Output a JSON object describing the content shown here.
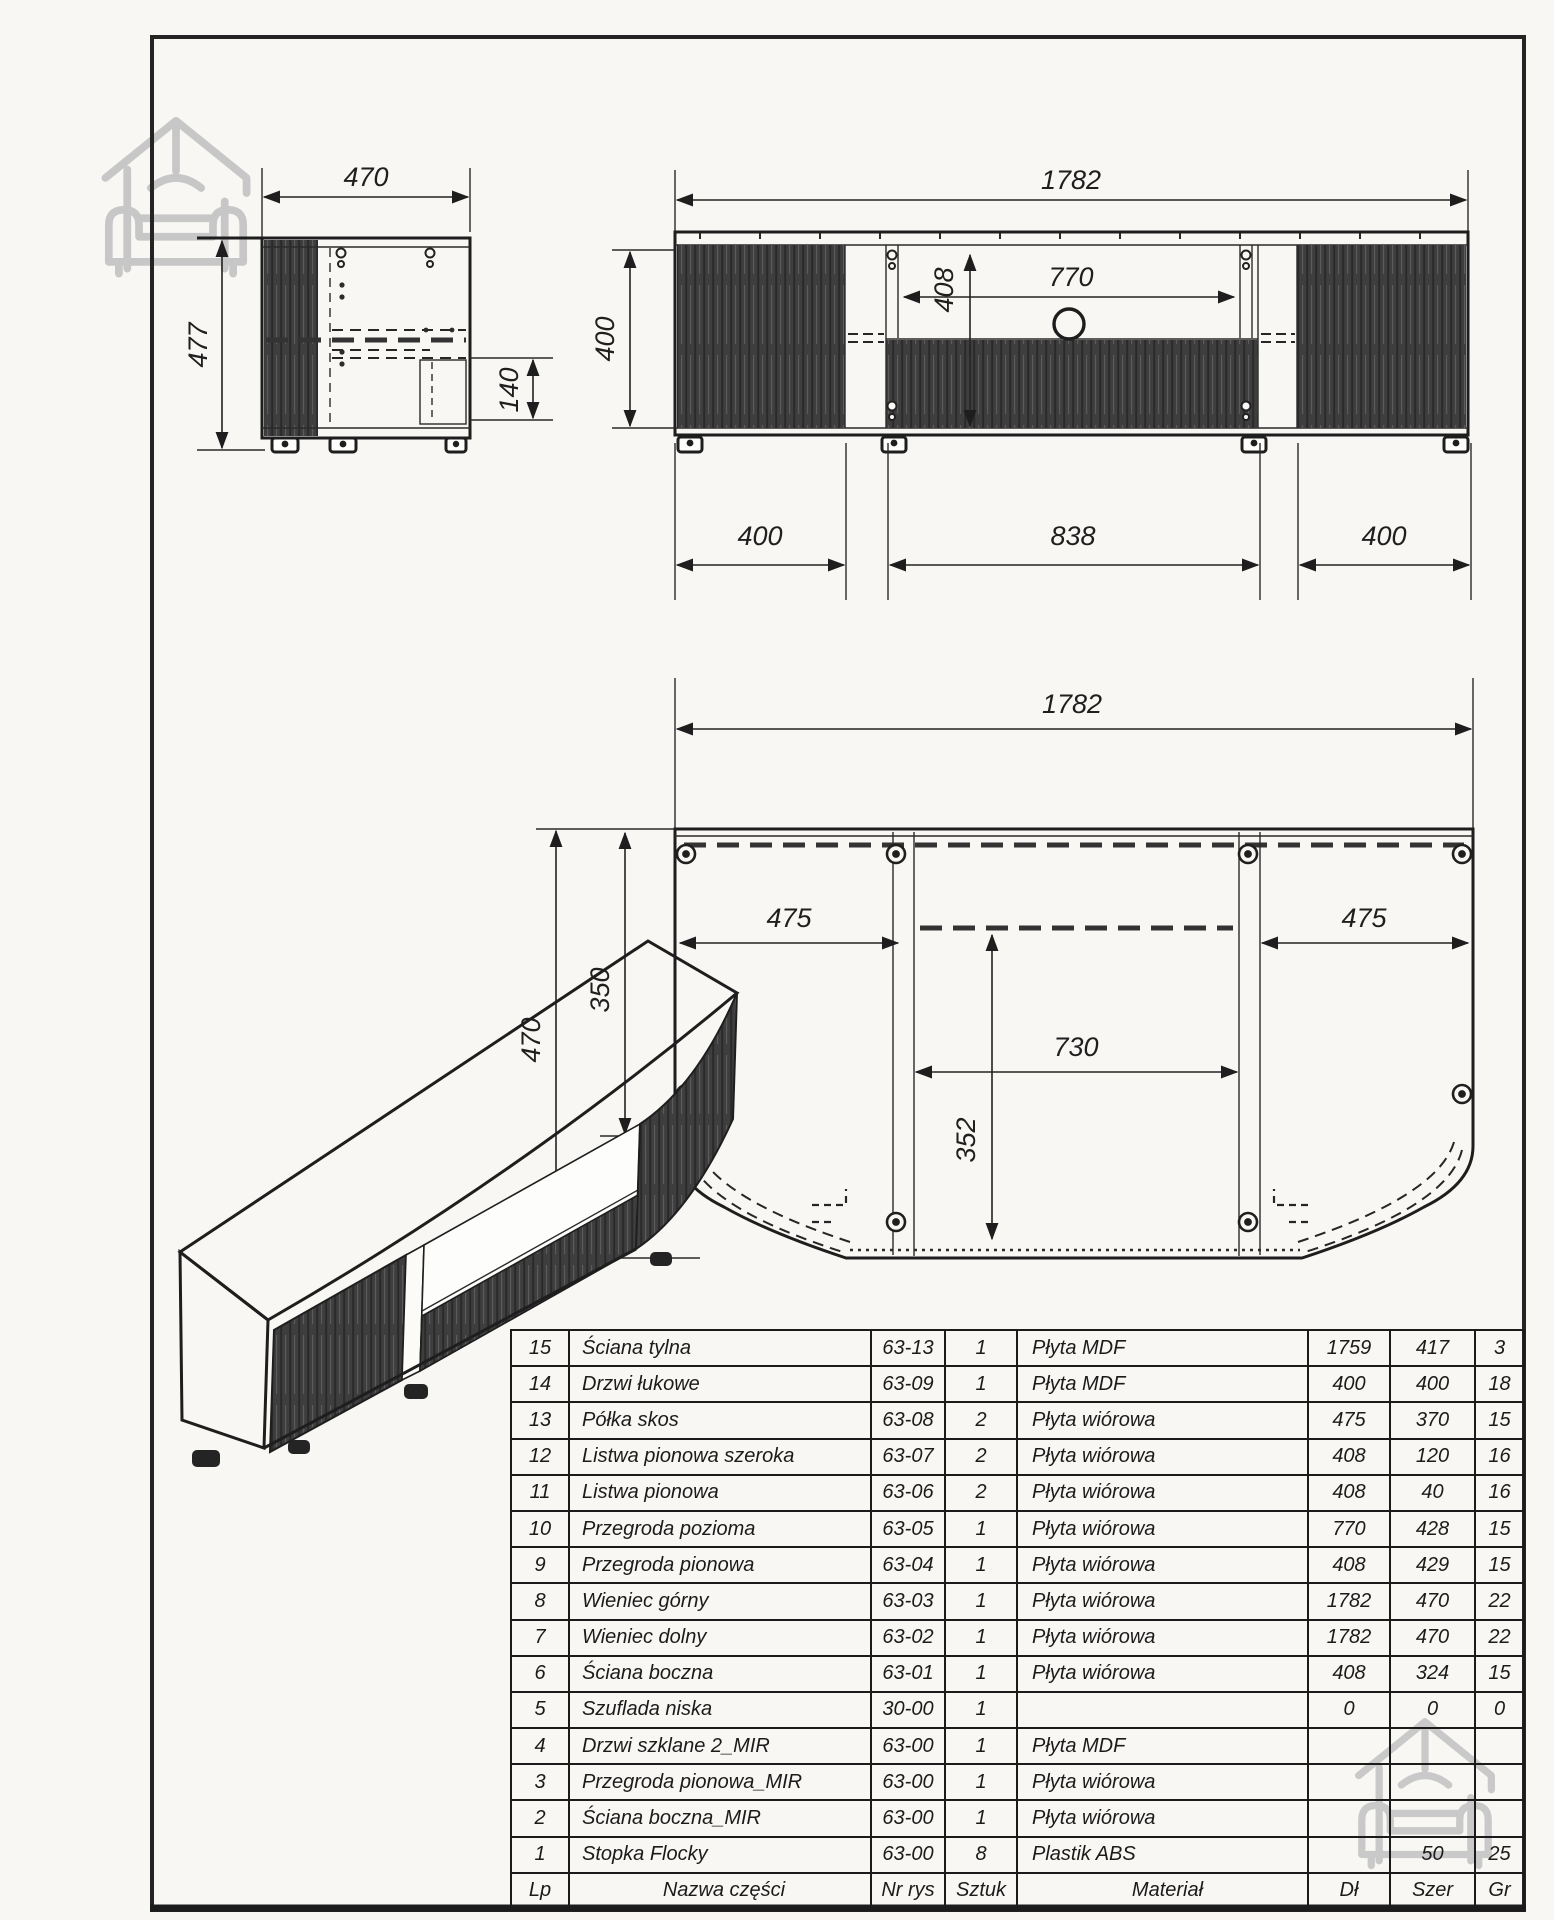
{
  "drawing": {
    "side_view": {
      "width": "470",
      "height": "477",
      "drawer_height": "140"
    },
    "front_view": {
      "total_width": "1782",
      "body_height": "400",
      "inner_height": "408",
      "niche_width": "770",
      "left_door_width": "400",
      "middle_width": "838",
      "right_door_width": "400"
    },
    "plan_view": {
      "total_width": "1782",
      "depth": "470",
      "inner_depth": "350",
      "left_shelf_width": "475",
      "niche_width": "730",
      "niche_depth": "352",
      "right_shelf_width": "475"
    }
  },
  "parts_table": {
    "headers": {
      "lp": "Lp",
      "name": "Nazwa części",
      "nr": "Nr rys",
      "qty": "Sztuk",
      "material": "Materiał",
      "len": "Dł",
      "wid": "Szer",
      "thk": "Gr"
    },
    "rows": [
      {
        "lp": "15",
        "name": "Ściana tylna",
        "nr": "63-13",
        "qty": "1",
        "material": "Płyta MDF",
        "len": "1759",
        "wid": "417",
        "thk": "3"
      },
      {
        "lp": "14",
        "name": "Drzwi łukowe",
        "nr": "63-09",
        "qty": "1",
        "material": "Płyta MDF",
        "len": "400",
        "wid": "400",
        "thk": "18"
      },
      {
        "lp": "13",
        "name": "Półka skos",
        "nr": "63-08",
        "qty": "2",
        "material": "Płyta wiórowa",
        "len": "475",
        "wid": "370",
        "thk": "15"
      },
      {
        "lp": "12",
        "name": "Listwa pionowa szeroka",
        "nr": "63-07",
        "qty": "2",
        "material": "Płyta wiórowa",
        "len": "408",
        "wid": "120",
        "thk": "16"
      },
      {
        "lp": "11",
        "name": "Listwa pionowa",
        "nr": "63-06",
        "qty": "2",
        "material": "Płyta wiórowa",
        "len": "408",
        "wid": "40",
        "thk": "16"
      },
      {
        "lp": "10",
        "name": "Przegroda pozioma",
        "nr": "63-05",
        "qty": "1",
        "material": "Płyta wiórowa",
        "len": "770",
        "wid": "428",
        "thk": "15"
      },
      {
        "lp": "9",
        "name": "Przegroda pionowa",
        "nr": "63-04",
        "qty": "1",
        "material": "Płyta wiórowa",
        "len": "408",
        "wid": "429",
        "thk": "15"
      },
      {
        "lp": "8",
        "name": "Wieniec górny",
        "nr": "63-03",
        "qty": "1",
        "material": "Płyta wiórowa",
        "len": "1782",
        "wid": "470",
        "thk": "22"
      },
      {
        "lp": "7",
        "name": "Wieniec dolny",
        "nr": "63-02",
        "qty": "1",
        "material": "Płyta wiórowa",
        "len": "1782",
        "wid": "470",
        "thk": "22"
      },
      {
        "lp": "6",
        "name": "Ściana boczna",
        "nr": "63-01",
        "qty": "1",
        "material": "Płyta wiórowa",
        "len": "408",
        "wid": "324",
        "thk": "15"
      },
      {
        "lp": "5",
        "name": "Szuflada niska",
        "nr": "30-00",
        "qty": "1",
        "material": "",
        "len": "0",
        "wid": "0",
        "thk": "0"
      },
      {
        "lp": "4",
        "name": "Drzwi szklane 2_MIR",
        "nr": "63-00",
        "qty": "1",
        "material": "Płyta MDF",
        "len": "",
        "wid": "",
        "thk": ""
      },
      {
        "lp": "3",
        "name": "Przegroda pionowa_MIR",
        "nr": "63-00",
        "qty": "1",
        "material": "Płyta wiórowa",
        "len": "",
        "wid": "",
        "thk": ""
      },
      {
        "lp": "2",
        "name": "Ściana boczna_MIR",
        "nr": "63-00",
        "qty": "1",
        "material": "Płyta wiórowa",
        "len": "",
        "wid": "",
        "thk": ""
      },
      {
        "lp": "1",
        "name": "Stopka Flocky",
        "nr": "63-00",
        "qty": "8",
        "material": "Plastik ABS",
        "len": "",
        "wid": "50",
        "thk": "25"
      }
    ]
  }
}
